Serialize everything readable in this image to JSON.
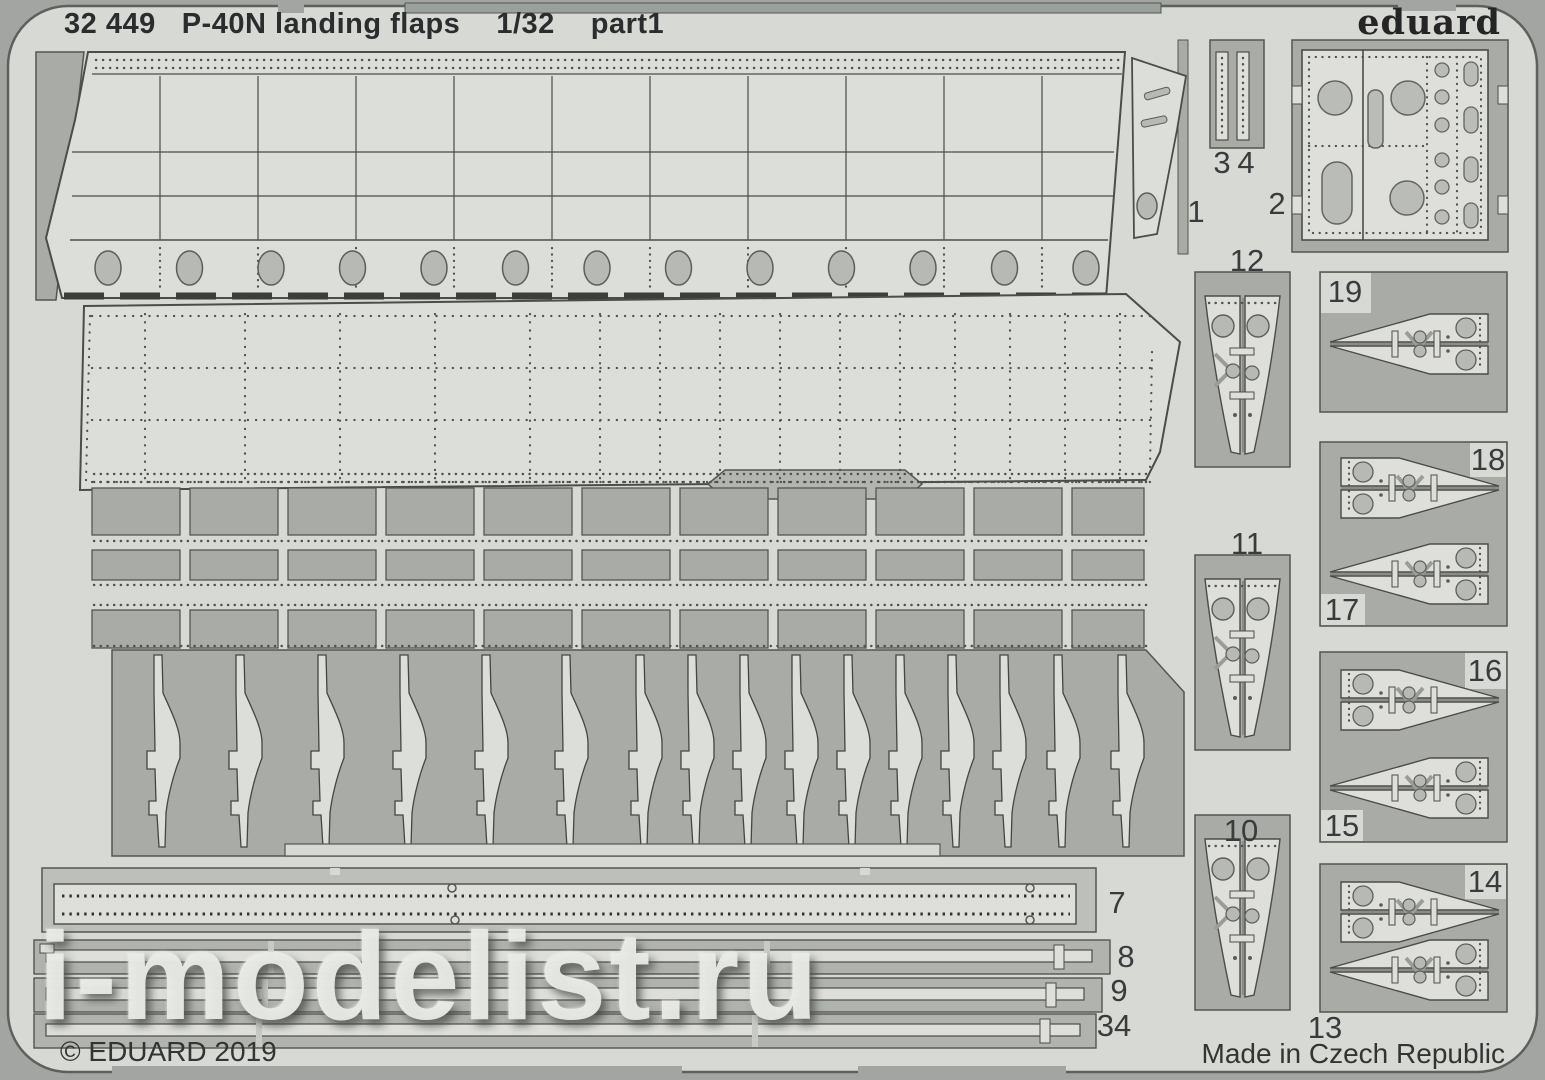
{
  "sheet": {
    "catalog_number": "32 449",
    "product_title": "P-40N landing flaps",
    "scale": "1/32",
    "part_designation": "part1",
    "brand": "eduard"
  },
  "footer": {
    "copyright": "© EDUARD 2019",
    "made_in": "Made in Czech Republic"
  },
  "watermark": {
    "text": "i-modelist.ru"
  },
  "part_numbers": {
    "p1": "1",
    "p2": "2",
    "p3": "3",
    "p4": "4",
    "p7": "7",
    "p8": "8",
    "p9": "9",
    "p10": "10",
    "p11": "11",
    "p12": "12",
    "p13": "13",
    "p14": "14",
    "p15": "15",
    "p16": "16",
    "p17": "17",
    "p18": "18",
    "p19": "19",
    "p34": "34"
  },
  "colors": {
    "background": "#a2a5a1",
    "sheet_metal": "#d7d9d4",
    "cutout": "#a8aba6",
    "part_fill": "#dcded9",
    "hole_fill": "#b6b9b4",
    "outline": "#4b4d48",
    "text": "#2e2f31"
  }
}
